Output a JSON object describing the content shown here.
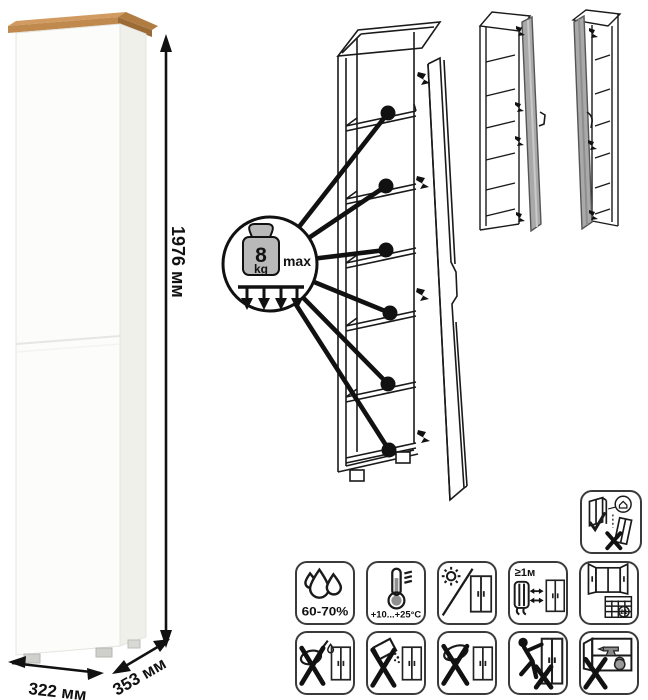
{
  "dimensions": {
    "height": "1976 мм",
    "width": "322 мм",
    "depth": "353 мм"
  },
  "shelf_load": {
    "value": "8",
    "unit": "kg",
    "qualifier": "max"
  },
  "care_icons": {
    "humidity": {
      "caption": "60-70%"
    },
    "temperature": {
      "caption": "+10...+25°C"
    },
    "heat_distance": {
      "caption": "≥1м"
    },
    "ventilation": {
      "calendar_day": "21"
    }
  },
  "colors": {
    "wood_top": "#c08a4e",
    "door_gray": "#a9a9a9",
    "line": "#1a1a1a",
    "weight_fill": "#b9b9b9"
  }
}
